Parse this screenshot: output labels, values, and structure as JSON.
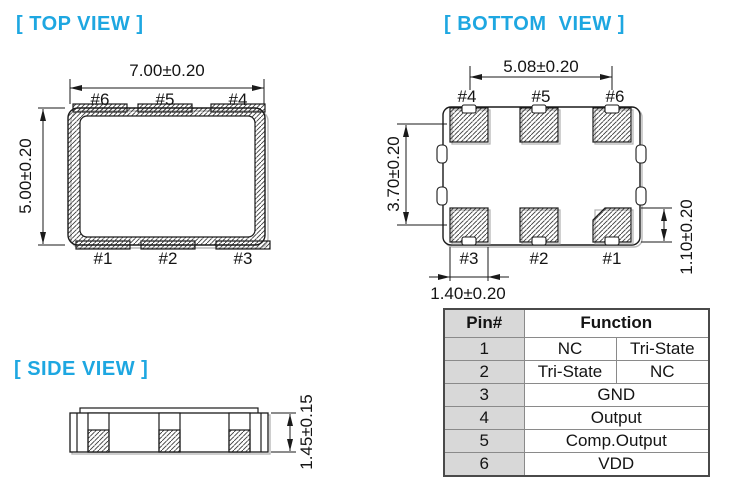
{
  "colors": {
    "accent": "#1ea7e1",
    "table_pin_column_fill": "#d8d8d8",
    "line": "#1a1a1a"
  },
  "views": {
    "top": {
      "title": "[ TOP VIEW ]",
      "body_width_dim": "7.00±0.20",
      "body_height_dim": "5.00±0.20",
      "pins_top": [
        "#6",
        "#5",
        "#4"
      ],
      "pins_bottom": [
        "#1",
        "#2",
        "#3"
      ]
    },
    "bottom": {
      "title": "[ BOTTOM  VIEW ]",
      "pad_span_dim": "5.08±0.20",
      "pad_row_pitch_dim": "3.70±0.20",
      "pad_height_dim": "1.10±0.20",
      "pad_width_dim": "1.40±0.20",
      "pins_top": [
        "#4",
        "#5",
        "#6"
      ],
      "pins_bottom": [
        "#3",
        "#2",
        "#1"
      ]
    },
    "side": {
      "title": "[ SIDE VIEW ]",
      "thickness_dim": "1.45±0.15"
    }
  },
  "pin_table": {
    "header": {
      "pin": "Pin#",
      "function": "Function"
    },
    "rows": [
      {
        "pin": "1",
        "function_left": "NC",
        "function_right": "Tri-State"
      },
      {
        "pin": "2",
        "function_left": "Tri-State",
        "function_right": "NC"
      },
      {
        "pin": "3",
        "function": "GND"
      },
      {
        "pin": "4",
        "function": "Output"
      },
      {
        "pin": "5",
        "function": "Comp.Output"
      },
      {
        "pin": "6",
        "function": "VDD"
      }
    ]
  }
}
